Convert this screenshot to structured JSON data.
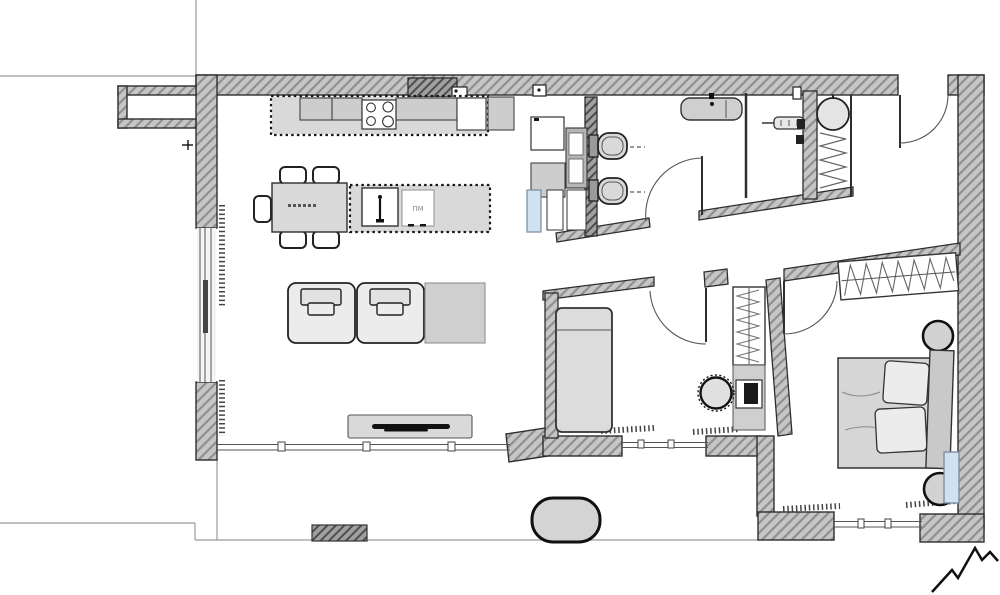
{
  "labels": {
    "island_appliance": "ПМ"
  },
  "palette": {
    "background": "#ffffff",
    "wall_fill": "#c6c6c6",
    "wall_hatch": "#8f8f8f",
    "outline": "#2b2b2b",
    "furniture_fill": "#d9d9d9",
    "furniture_light": "#ececec",
    "accent_blue": "#cfe2f0",
    "site_line": "#9a9a9a",
    "dark_element": "#161616"
  },
  "rooms": [
    {
      "name": "living-dining-kitchen",
      "items": [
        "kitchen-counter",
        "cooktop-4-burners",
        "tall-appliance-column",
        "kitchen-island",
        "island-sink",
        "dishwasher",
        "dining-table",
        "dining-chairs",
        "armchair-left",
        "armchair-right",
        "side-table",
        "tv-console",
        "tv"
      ]
    },
    {
      "name": "bathroom",
      "items": [
        "wall-hung-toilet-1",
        "wall-hung-toilet-2",
        "vanity-sink",
        "bathroom-door"
      ]
    },
    {
      "name": "shower-room",
      "items": [
        "towel-radiator",
        "wall-fixtures"
      ]
    },
    {
      "name": "tech-closet",
      "items": [
        "boiler",
        "heating-coil"
      ]
    },
    {
      "name": "entry-hall",
      "items": [
        "entrance-door"
      ]
    },
    {
      "name": "middle-room",
      "items": [
        "single-bed",
        "hanging-wardrobe",
        "desk",
        "monitor",
        "desk-chair",
        "room-door"
      ]
    },
    {
      "name": "bedroom",
      "items": [
        "double-bed",
        "pillows",
        "headboard",
        "nightstand-top",
        "nightstand-bottom",
        "hanging-wardrobe",
        "ac-radiator",
        "room-door"
      ]
    },
    {
      "name": "terrace",
      "items": [
        "outdoor-pouf",
        "paving-step",
        "north-mark"
      ]
    }
  ]
}
